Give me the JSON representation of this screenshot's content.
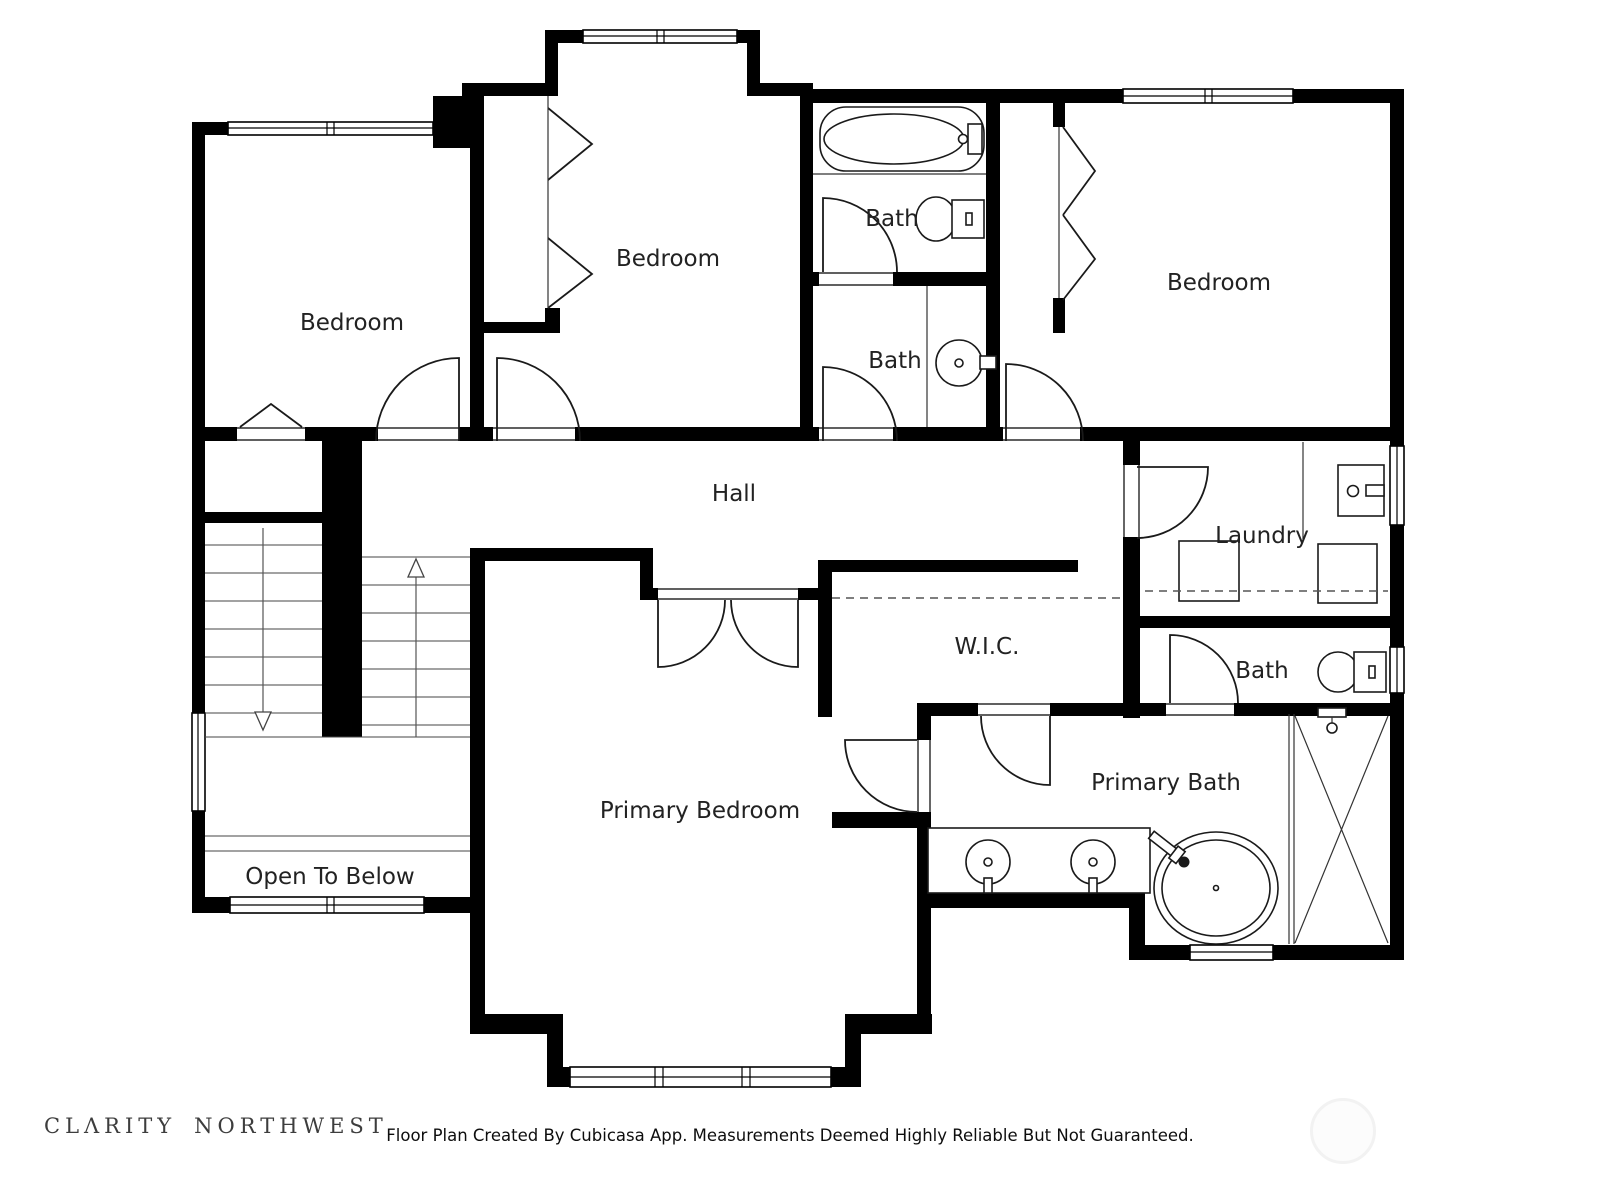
{
  "plan_title": "Second Floor Plan",
  "rooms": [
    {
      "key": "bedroom_left",
      "label": "Bedroom"
    },
    {
      "key": "bedroom_middle",
      "label": "Bedroom"
    },
    {
      "key": "bedroom_right",
      "label": "Bedroom"
    },
    {
      "key": "bath_top",
      "label": "Bath"
    },
    {
      "key": "bath_middle",
      "label": "Bath"
    },
    {
      "key": "hall",
      "label": "Hall"
    },
    {
      "key": "laundry",
      "label": "Laundry"
    },
    {
      "key": "bath_right",
      "label": "Bath"
    },
    {
      "key": "wic",
      "label": "W.I.C."
    },
    {
      "key": "primary_bedroom",
      "label": "Primary Bedroom"
    },
    {
      "key": "primary_bath",
      "label": "Primary Bath"
    },
    {
      "key": "open_to_below",
      "label": "Open To Below"
    }
  ],
  "fixtures": [
    "bathtub-icon",
    "toilet-icon",
    "pedestal-sink-icon",
    "laundry-sink-icon",
    "washer-icon",
    "dryer-icon",
    "double-vanity-sink-icon",
    "freestanding-tub-icon",
    "shower-icon",
    "shower-head-icon",
    "stairs-up-arrow-icon",
    "stairs-down-arrow-icon",
    "bifold-closet-door-icon",
    "window-icon",
    "door-swing-icon"
  ],
  "footer": {
    "logo_word1": "CLΛRITY",
    "logo_word2": "NORTHWEST",
    "disclaimer": "Floor Plan Created By Cubicasa App. Measurements Deemed Highly Reliable But Not Guaranteed."
  },
  "colors": {
    "wall": "#000000",
    "background": "#ffffff",
    "label_text": "#222222",
    "disclaimer_text": "#0d0d0d",
    "logo_text": "#3d3d3d",
    "watermark_ring": "#f2f2f2"
  }
}
